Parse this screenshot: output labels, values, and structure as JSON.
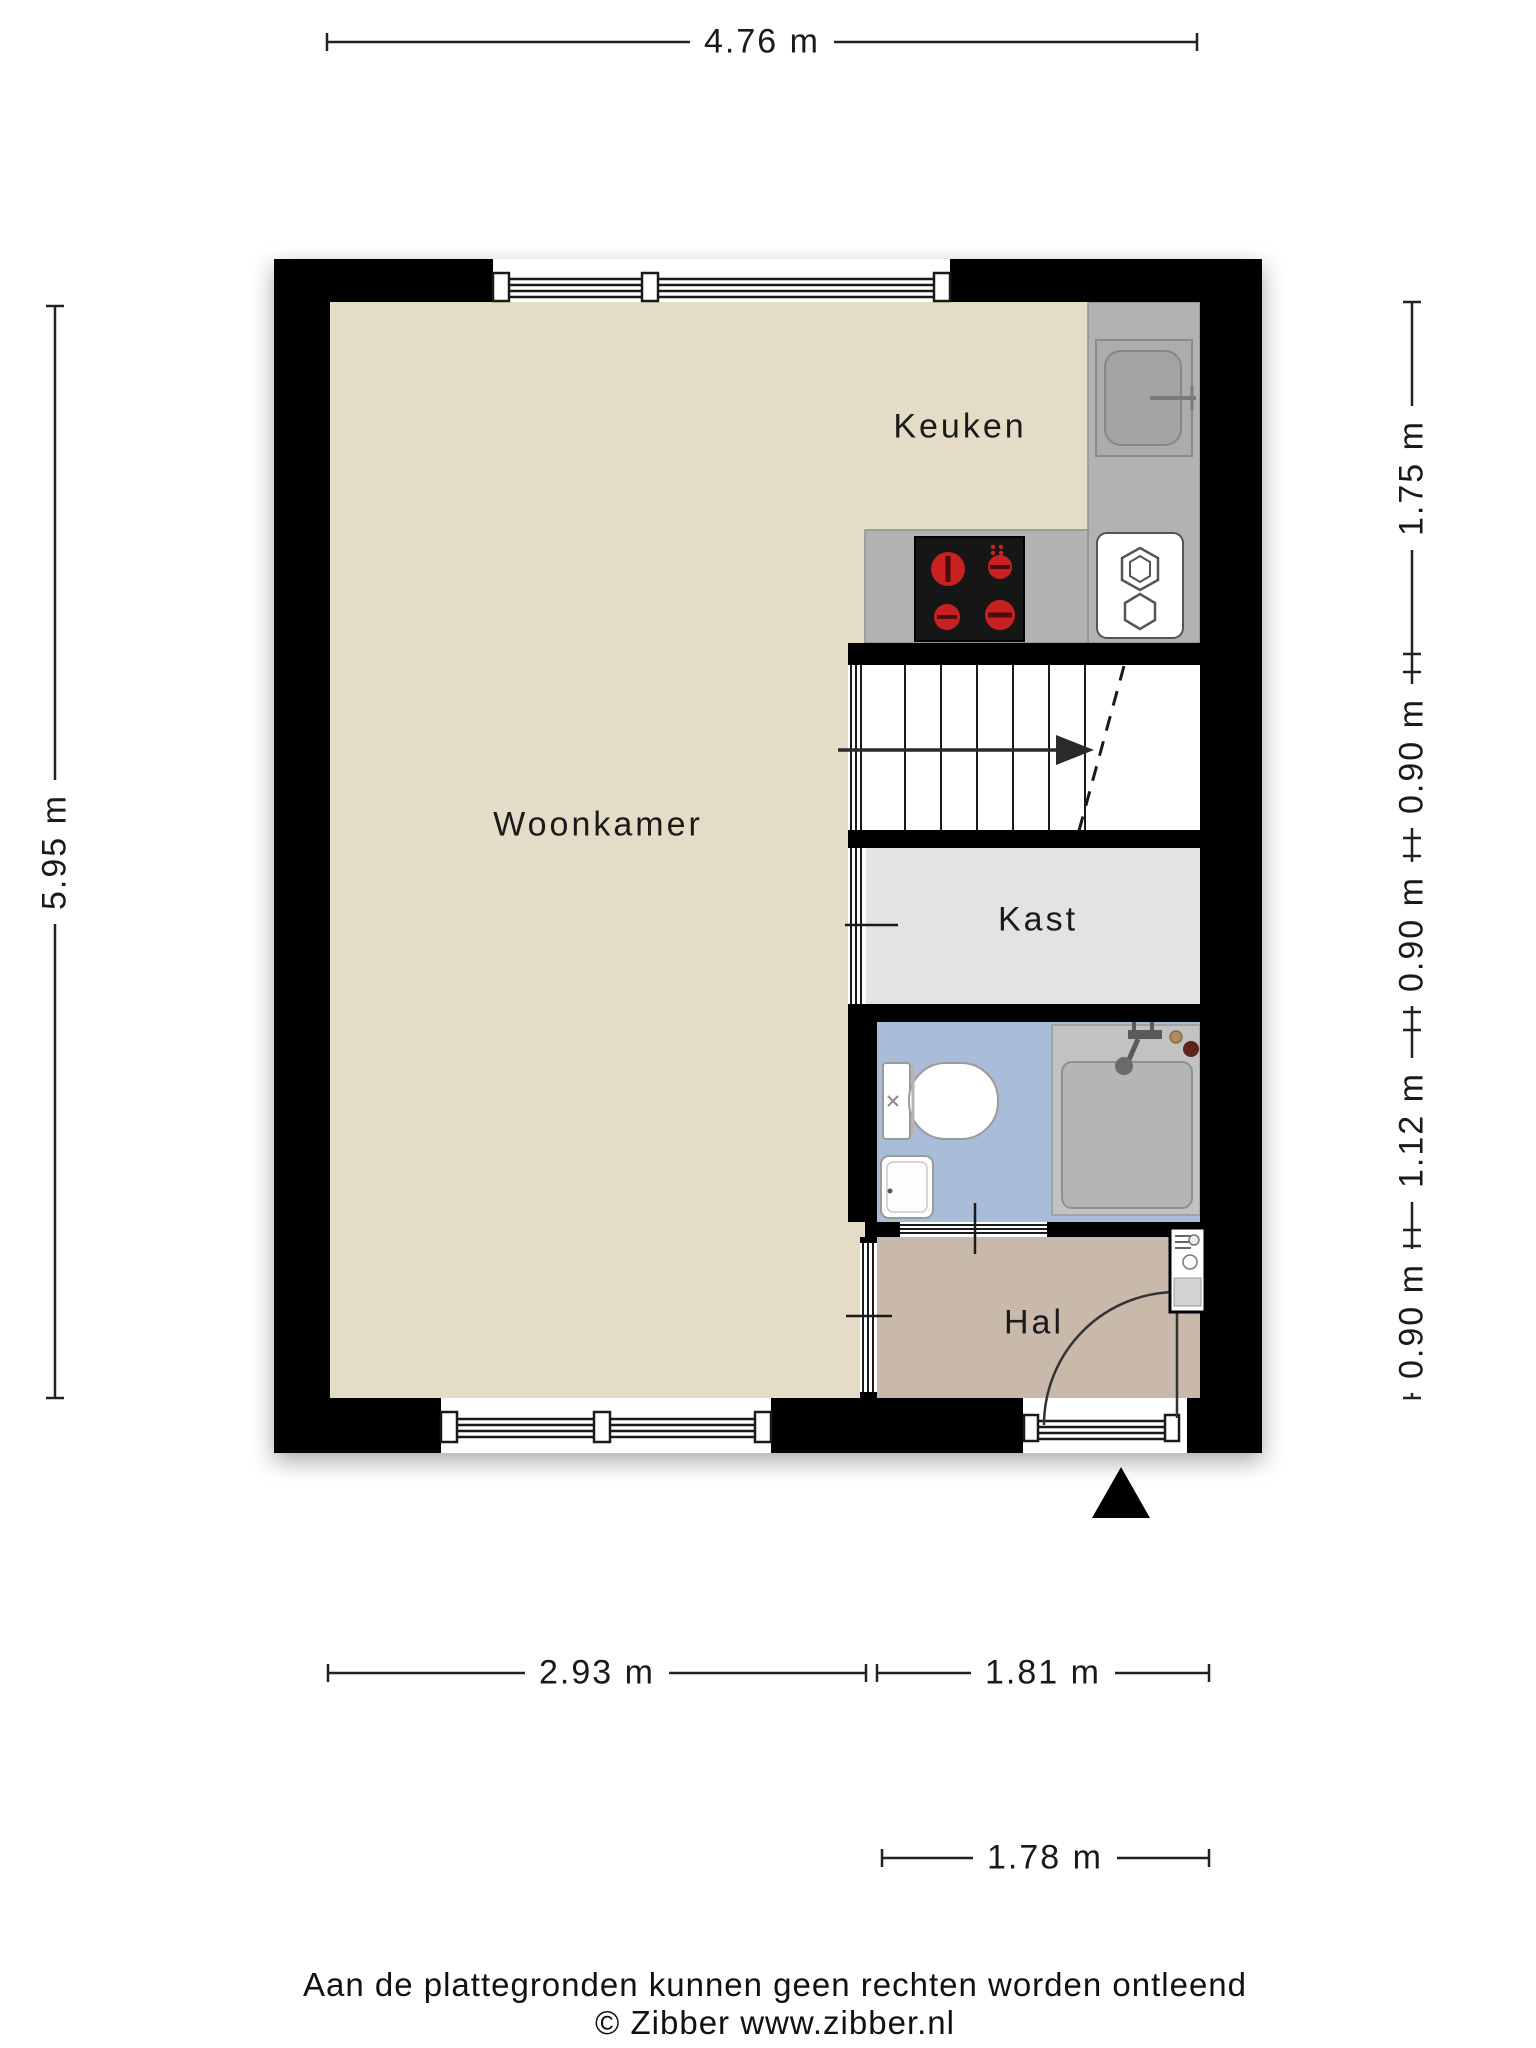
{
  "title": "Begane grond plattegrond",
  "rooms": [
    {
      "id": "keuken",
      "label": "Keuken"
    },
    {
      "id": "woonkamer",
      "label": "Woonkamer"
    },
    {
      "id": "kast",
      "label": "Kast"
    },
    {
      "id": "hal",
      "label": "Hal"
    }
  ],
  "dimensions": {
    "top": {
      "label": "4.76 m"
    },
    "left": {
      "label": "5.95 m"
    },
    "right": {
      "segments": [
        {
          "label": "1.75 m"
        },
        {
          "label": "0.90 m"
        },
        {
          "label": "0.90 m"
        },
        {
          "label": "1.12 m"
        },
        {
          "label": "0.90 m"
        }
      ]
    },
    "bottom": {
      "segments": [
        {
          "label": "2.93 m"
        },
        {
          "label": "1.81 m"
        }
      ]
    },
    "entrance": {
      "label": "1.78 m"
    }
  },
  "footer": {
    "line1": "Aan de plattegronden kunnen geen rechten worden ontleend",
    "line2": "© Zibber www.zibber.nl"
  },
  "fixtures": [
    "kitchen-sink",
    "kitchen-stove",
    "boiler",
    "staircase",
    "stairs-direction-arrow",
    "toilet",
    "washbasin",
    "shower",
    "meter-cabinet",
    "entrance-door",
    "entrance-arrow",
    "window",
    "interior-door"
  ],
  "colors": {
    "wall": "#000000",
    "living-floor": "#e4dcc6",
    "closet-floor": "#e3e3e3",
    "bathroom-floor": "#a9bdd9",
    "hall-floor": "#c9b9aa",
    "counter": "#b2b2b2",
    "shower-tray": "#b5b5b5",
    "stove": "#161616",
    "burner": "#c92121",
    "dimension-line": "#222222"
  }
}
